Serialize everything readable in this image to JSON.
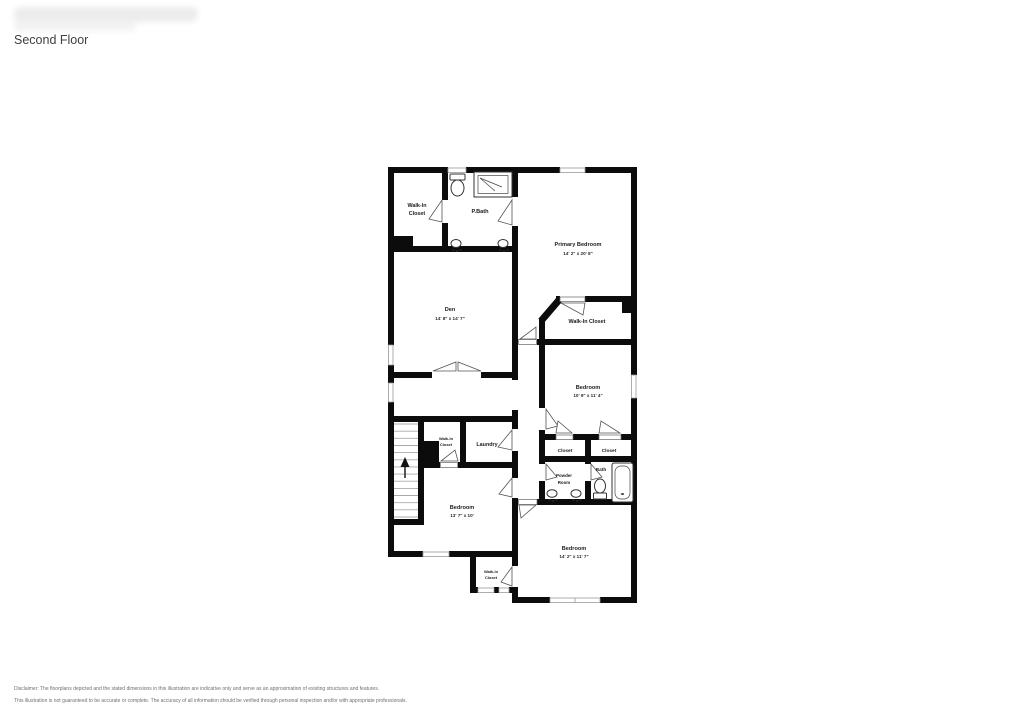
{
  "header": {
    "title": "Second Floor"
  },
  "floorplan": {
    "rooms": {
      "walk_in_closet_top": {
        "line1": "Walk-In",
        "line2": "Closet"
      },
      "primary_bath": {
        "line1": "P.Bath"
      },
      "primary_bedroom": {
        "line1": "Primary Bedroom",
        "dims": "14' 2\" x 20' 8\""
      },
      "den": {
        "line1": "Den",
        "dims": "14' 8\" x 14' 7\""
      },
      "walk_in_closet_primary": {
        "line1": "Walk-In Closet"
      },
      "bedroom_mid_right": {
        "line1": "Bedroom",
        "dims": "10' 9\" x 11' 4\""
      },
      "walk_in_closet_hall": {
        "line1": "Walk-In",
        "line2": "Closet"
      },
      "laundry": {
        "line1": "Laundry"
      },
      "closet_left": {
        "line1": "Closet"
      },
      "closet_right": {
        "line1": "Closet"
      },
      "powder_room": {
        "line1": "Powder",
        "line2": "Room"
      },
      "bath": {
        "line1": "Bath"
      },
      "bedroom_left": {
        "line1": "Bedroom",
        "dims": "13' 7\" x 10'"
      },
      "bedroom_bottom_right": {
        "line1": "Bedroom",
        "dims": "14' 2\" x 11' 7\""
      },
      "walk_in_closet_bottom": {
        "line1": "Walk-In",
        "line2": "Closet"
      }
    }
  },
  "footer": {
    "disclaimer_line1": "Disclaimer: The floorplans depicted and the stated dimensions in this illustration are indicative only and serve as an approximation of existing structures and features.",
    "disclaimer_line2": "This illustration is not guaranteed to be accurate or complete. The accuracy of all information should be verified through personal inspection and/or with appropriate professionals."
  }
}
